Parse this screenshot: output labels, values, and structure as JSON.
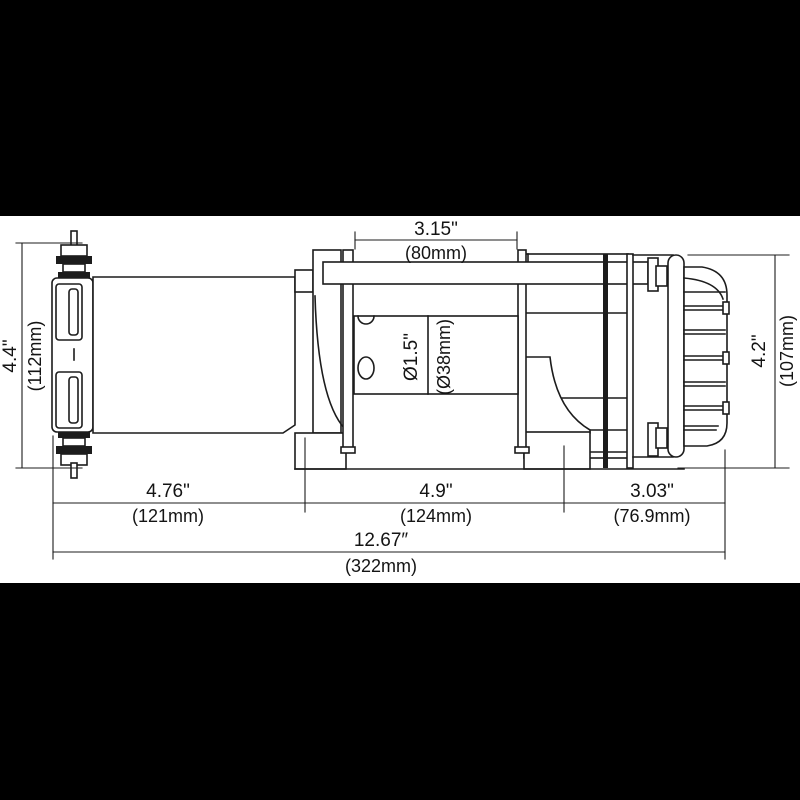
{
  "drawing": {
    "type": "technical-dimension-diagram",
    "subject": "electric winch side view",
    "dimensions": {
      "top_width": {
        "inches": "3.15\"",
        "metric": "(80mm)"
      },
      "left_height": {
        "inches": "4.4\"",
        "metric": "(112mm)"
      },
      "right_height": {
        "inches": "4.2\"",
        "metric": "(107mm)"
      },
      "drum_diameter": {
        "inches": "Ø1.5\"",
        "metric": "(Ø38mm)"
      },
      "bottom_left": {
        "inches": "4.76\"",
        "metric": "(121mm)"
      },
      "bottom_middle": {
        "inches": "4.9\"",
        "metric": "(124mm)"
      },
      "bottom_right": {
        "inches": "3.03\"",
        "metric": "(76.9mm)"
      },
      "overall_length": {
        "inches": "12.67″",
        "metric": "(322mm)"
      }
    },
    "colors": {
      "line": "#1c1c1c",
      "paper": "#ffffff",
      "letterbox": "#000000"
    }
  }
}
